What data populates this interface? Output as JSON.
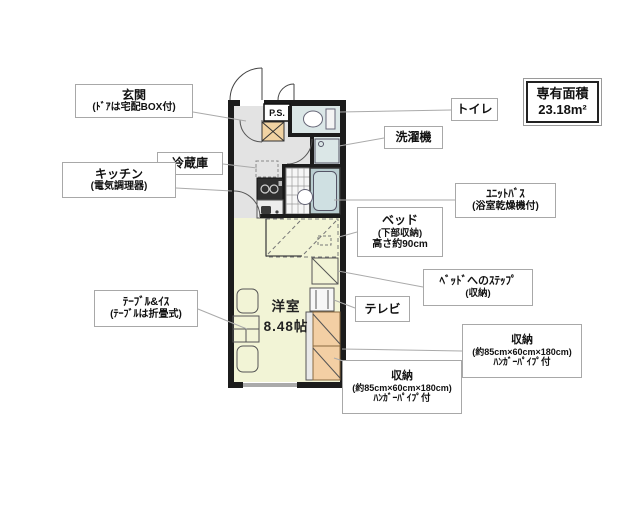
{
  "area_box": {
    "line1": "専有面積",
    "line2": "23.18m²"
  },
  "plan_texts": {
    "ps": "P.S.",
    "room_name": "洋室",
    "room_size": "8.48帖"
  },
  "labels": {
    "entrance": {
      "line1": "玄関",
      "line2": "(ﾄﾞｱは宅配BOX付)"
    },
    "fridge": {
      "line1": "冷蔵庫"
    },
    "kitchen": {
      "line1": "キッチン",
      "line2": "(電気調理器)"
    },
    "toilet": {
      "line1": "トイレ"
    },
    "washer": {
      "line1": "洗濯機"
    },
    "unit_bath": {
      "line1": "ﾕﾆｯﾄﾊﾞｽ",
      "line2": "(浴室乾燥機付)"
    },
    "bed": {
      "line1": "ベッド",
      "line2": "(下部収納)",
      "line3": "高さ約90cm"
    },
    "bed_step": {
      "line1": "ﾍﾞｯﾄﾞへのｽﾃｯﾌﾟ",
      "line2": "(収納)"
    },
    "tv": {
      "line1": "テレビ"
    },
    "storage_right": {
      "line1": "収納",
      "line2": "(約85cm×60cm×180cm)",
      "line3": "ﾊﾝｶﾞｰﾊﾟｲﾌﾟ付"
    },
    "storage_bottom": {
      "line1": "収納",
      "line2": "(約85cm×60cm×180cm)",
      "line3": "ﾊﾝｶﾞｰﾊﾟｲﾌﾟ付"
    },
    "table": {
      "line1": "ﾃｰﾌﾞﾙ&ｲｽ",
      "line2": "(ﾃｰﾌﾞﾙは折畳式)"
    }
  },
  "colors": {
    "wall": "#1c1c1c",
    "hall_floor": "#e3e3e3",
    "room_floor": "#f2f4d6",
    "wet_floor": "#dbe7e7",
    "closet": "#f3cfa4",
    "tub": "#cfe0e2",
    "label_border": "#a8a8a8",
    "leader": "#aaaaaa"
  }
}
